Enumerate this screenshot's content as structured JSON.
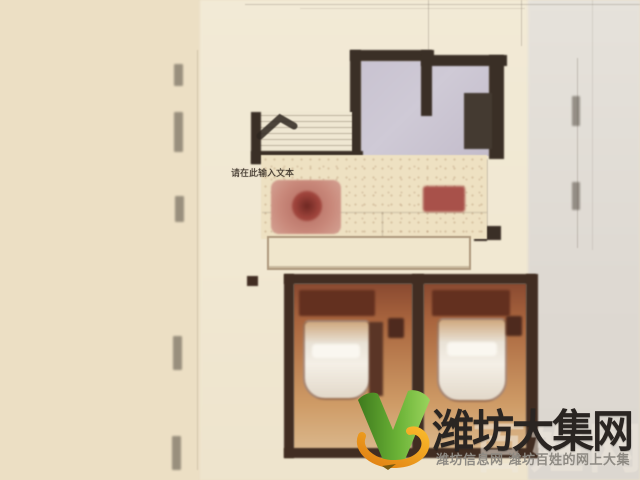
{
  "overlay": {
    "text_placeholder": "请在此输入文本"
  },
  "watermark": {
    "site_name": "潍坊大集网",
    "tagline": "潍坊信息网 潍坊百姓的网上大集",
    "ghost_text": "百姓网",
    "logo_icon": "green-v-with-orange-swoosh",
    "colors": {
      "logo_green_dark": "#3e7a1d",
      "logo_green_light": "#9ad45d",
      "logo_orange": "#f0971c",
      "site_name_color": "#2a2522",
      "tagline_color": "#8e8a83"
    }
  },
  "palette": {
    "backdrop_left": "#ecdfc4",
    "plan_paper": "#f1e8d2",
    "backdrop_right": "#dedad3",
    "wall": "#3a2f26",
    "bathroom_floor": "#c9c3d1",
    "living_floor": "#eee1c2",
    "dining_set_red": "#b05a50",
    "bedroom_warm": "#b5713f"
  }
}
